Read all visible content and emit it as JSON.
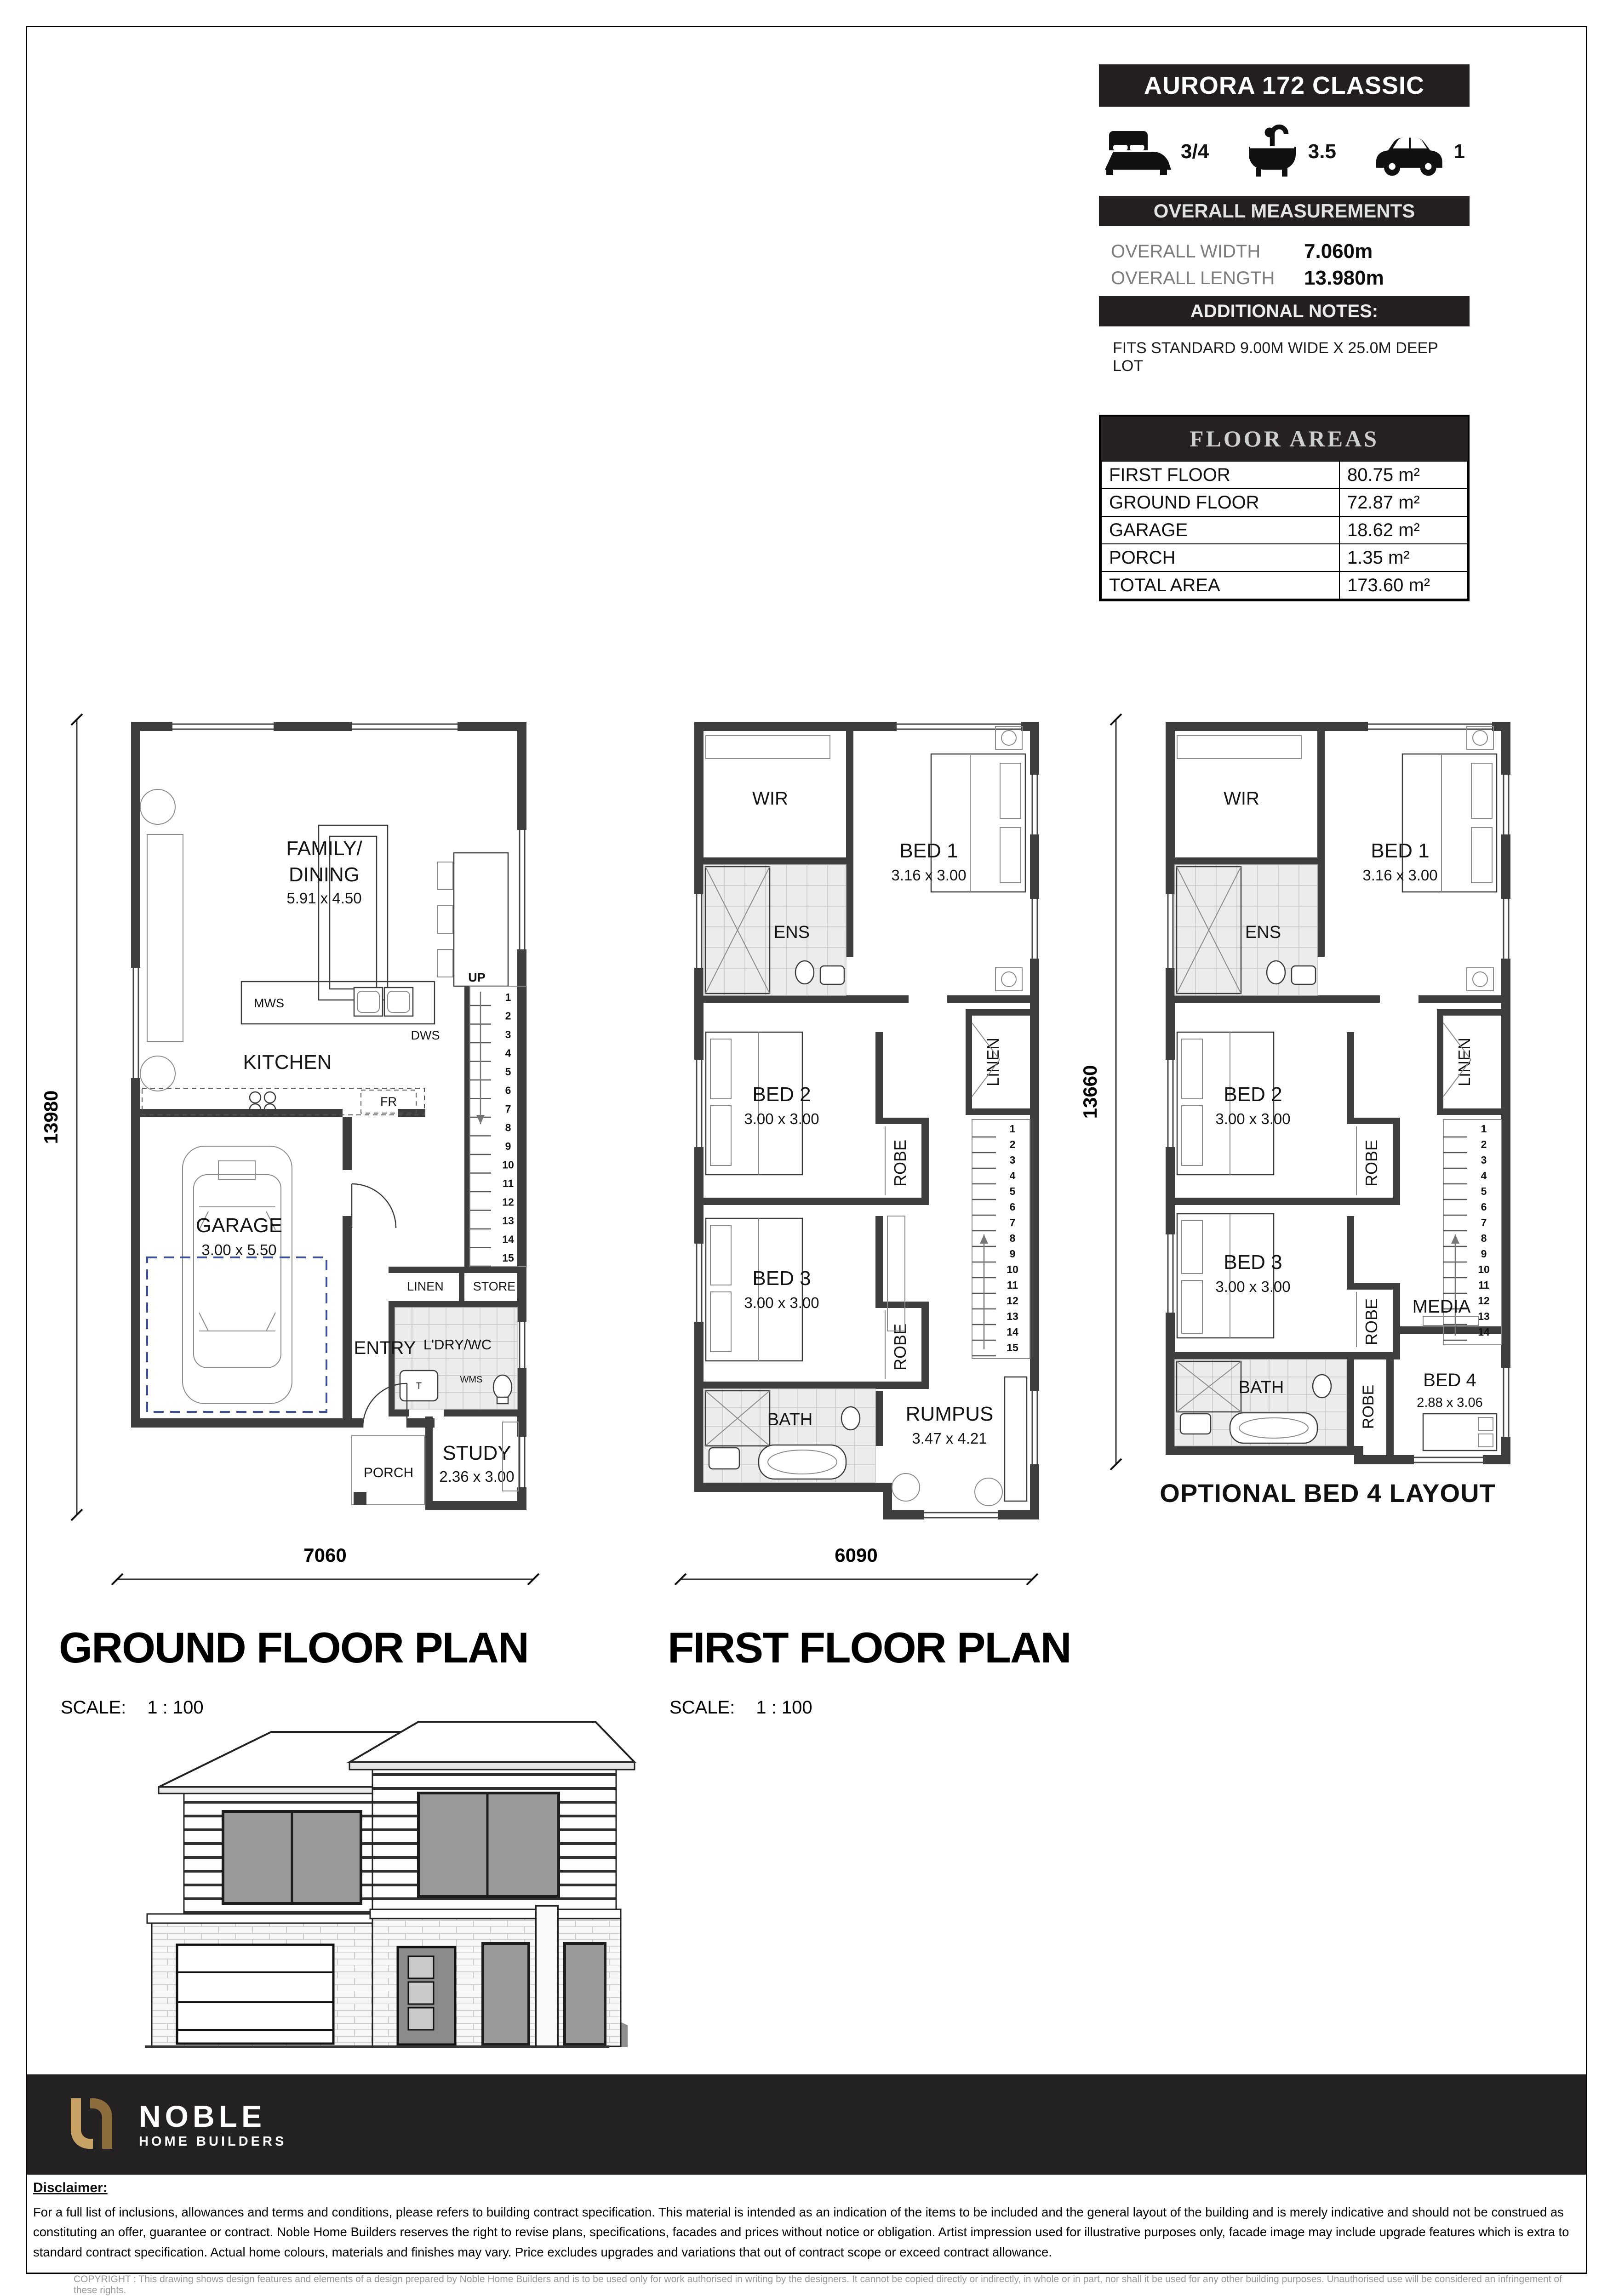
{
  "panel": {
    "title": "AURORA 172 CLASSIC",
    "stats": [
      {
        "icon": "bed-icon",
        "value": "3/4"
      },
      {
        "icon": "bath-icon",
        "value": "3.5"
      },
      {
        "icon": "car-icon",
        "value": "1"
      }
    ],
    "measurements": {
      "header": "OVERALL MEASUREMENTS",
      "rows": [
        {
          "label": "OVERALL WIDTH",
          "value": "7.060m"
        },
        {
          "label": "OVERALL LENGTH",
          "value": "13.980m"
        }
      ]
    },
    "notes": {
      "header": "ADDITIONAL NOTES:",
      "text": "FITS STANDARD 9.00M WIDE X 25.0M DEEP LOT"
    },
    "floor_areas": {
      "header": "FLOOR AREAS",
      "rows": [
        {
          "label": "FIRST FLOOR",
          "value": "80.75 m²"
        },
        {
          "label": "GROUND FLOOR",
          "value": "72.87 m²"
        },
        {
          "label": "GARAGE",
          "value": "18.62 m²"
        },
        {
          "label": "PORCH",
          "value": "1.35 m²"
        },
        {
          "label": "TOTAL AREA",
          "value": "173.60 m²"
        }
      ]
    }
  },
  "ground_floor": {
    "title": "GROUND FLOOR PLAN",
    "scale_label": "SCALE:",
    "scale_value": "1 : 100",
    "dims": {
      "width": "7060",
      "height": "13980"
    },
    "rooms": {
      "family1": "FAMILY/",
      "family2": "DINING",
      "family_size": "5.91 x 4.50",
      "kitchen": "KITCHEN",
      "mws": "MWS",
      "dws": "DWS",
      "fr": "FR",
      "up": "UP",
      "linen": "LINEN",
      "store": "STORE",
      "laundry": "L'DRY/WC",
      "wms": "WMS",
      "trough": "T",
      "garage": "GARAGE",
      "garage_size": "3.00 x 5.50",
      "entry": "ENTRY",
      "study": "STUDY",
      "study_size": "2.36 x 3.00",
      "porch": "PORCH"
    },
    "stair_numbers": [
      "1",
      "2",
      "3",
      "4",
      "5",
      "6",
      "7",
      "8",
      "9",
      "10",
      "11",
      "12",
      "13",
      "14",
      "15"
    ]
  },
  "first_floor": {
    "title": "FIRST FLOOR PLAN",
    "scale_label": "SCALE:",
    "scale_value": "1 : 100",
    "dims": {
      "width": "6090"
    },
    "rooms": {
      "wir": "WIR",
      "ens": "ENS",
      "bed1": "BED 1",
      "bed1_size": "3.16 x 3.00",
      "bed2": "BED 2",
      "bed2_size": "3.00 x 3.00",
      "robe_bed2": "ROBE",
      "linen": "LINEN",
      "bed3": "BED 3",
      "bed3_size": "3.00 x 3.00",
      "robe_bed3": "ROBE",
      "bath": "BATH",
      "rumpus": "RUMPUS",
      "rumpus_size": "3.47 x 4.21"
    },
    "stair_numbers": [
      "1",
      "2",
      "3",
      "4",
      "5",
      "6",
      "7",
      "8",
      "9",
      "10",
      "11",
      "12",
      "13",
      "14",
      "15"
    ]
  },
  "optional_floor": {
    "caption": "OPTIONAL BED 4 LAYOUT",
    "dims": {
      "height": "13660"
    },
    "rooms": {
      "wir": "WIR",
      "ens": "ENS",
      "bed1": "BED 1",
      "bed1_size": "3.16 x 3.00",
      "bed2": "BED 2",
      "bed2_size": "3.00 x 3.00",
      "robe_bed2": "ROBE",
      "linen": "LINEN",
      "bed3": "BED 3",
      "bed3_size": "3.00 x 3.00",
      "robe_bed3": "ROBE",
      "bath": "BATH",
      "media": "MEDIA",
      "robe_bed4": "ROBE",
      "bed4": "BED 4",
      "bed4_size": "2.88 x 3.06"
    },
    "stair_numbers": [
      "1",
      "2",
      "3",
      "4",
      "5",
      "6",
      "7",
      "8",
      "9",
      "10",
      "11",
      "12",
      "13",
      "14"
    ]
  },
  "footer": {
    "brand": "NOBLE",
    "brand_sub": "HOME BUILDERS",
    "disclaimer_heading": "Disclaimer:",
    "disclaimer_text": "For a full list of inclusions, allowances and terms and conditions, please refers to building contract specification. This material is intended as an indication of the items to be included and the general layout of the building and is merely indicative and should not be construed as constituting an offer, guarantee or contract. Noble Home Builders reserves the right to revise plans, specifications, facades and prices without notice or obligation. Artist impression used for illustrative purposes only, facade image may include upgrade features which is extra to standard contract specification. Actual home colours, materials and finishes may vary. Price excludes upgrades and variations that out of contract scope or exceed contract allowance.",
    "copyright_text": "COPYRIGHT : This drawing shows design features and elements of a design prepared by Noble Home Builders and is to be used only for work authorised in writing by the designers. It cannot be copied directly or indirectly, in whole or in part, nor shall it be used for any other building purposes. Unauthorised use will be considered an infringement of these rights."
  },
  "colors": {
    "panel_dark": "#231f20",
    "wall": "#3e3e3e",
    "garage_dash": "#3b4fa0",
    "logo_gold_light": "#c7a264",
    "logo_gold_dark": "#8d6c3e"
  }
}
